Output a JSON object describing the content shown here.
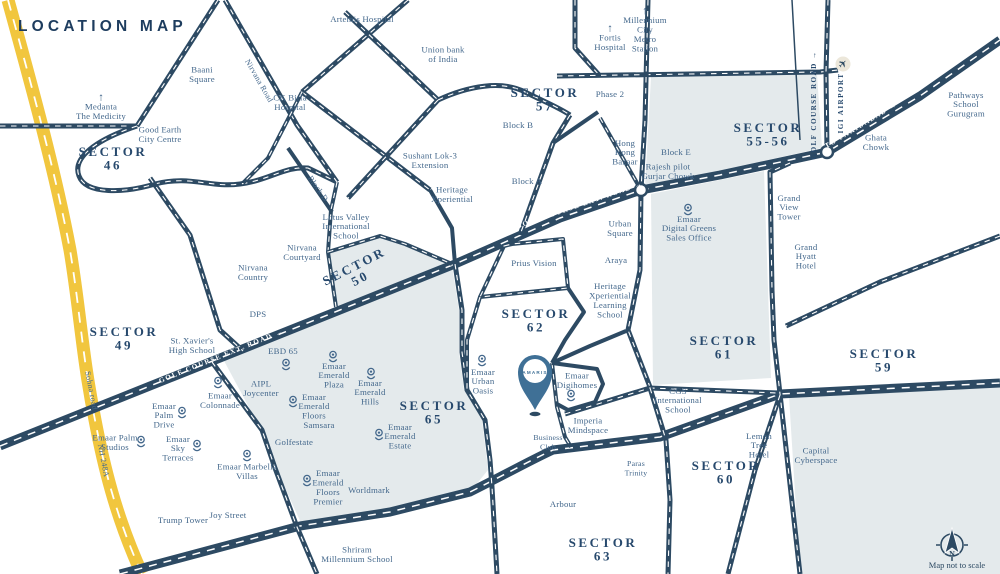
{
  "title": "LOCATION MAP",
  "footer": {
    "compass_label": "N",
    "disclaimer": "Map not to scale"
  },
  "colors": {
    "road": "#2d4a63",
    "road_dash": "#ffffff",
    "highway_yellow": "#f1c63e",
    "region": "#e4eaec",
    "label": "#44688c",
    "sector_label": "#27496d",
    "title": "#1d3c5e",
    "pin_fill": "#3f7096",
    "airport_bg": "#ece7da"
  },
  "map": {
    "project_pin": {
      "label": "AMARIS",
      "x": 535,
      "y": 372
    },
    "compass": {
      "x": 952,
      "y": 545
    },
    "airport_icon": {
      "x": 843,
      "y": 64
    },
    "junctions": [
      {
        "x": 641,
        "y": 190
      },
      {
        "x": 827,
        "y": 152
      }
    ],
    "sector_labels": [
      {
        "x": 113,
        "y": 158,
        "lines": [
          "SECTOR",
          "46"
        ]
      },
      {
        "x": 545,
        "y": 99,
        "lines": [
          "SECTOR",
          "57"
        ]
      },
      {
        "x": 768,
        "y": 134,
        "lines": [
          "SECTOR",
          "55-56"
        ]
      },
      {
        "x": 124,
        "y": 338,
        "lines": [
          "SECTOR",
          "49"
        ]
      },
      {
        "x": 357,
        "y": 272,
        "lines": [
          "SECTOR",
          "50"
        ],
        "rotate": -27
      },
      {
        "x": 536,
        "y": 320,
        "lines": [
          "SECTOR",
          "62"
        ]
      },
      {
        "x": 724,
        "y": 347,
        "lines": [
          "SECTOR",
          "61"
        ]
      },
      {
        "x": 884,
        "y": 360,
        "lines": [
          "SECTOR",
          "59"
        ]
      },
      {
        "x": 434,
        "y": 412,
        "lines": [
          "SECTOR",
          "65"
        ]
      },
      {
        "x": 726,
        "y": 472,
        "lines": [
          "SECTOR",
          "60"
        ]
      },
      {
        "x": 603,
        "y": 549,
        "lines": [
          "SECTOR",
          "63"
        ]
      }
    ],
    "road_labels": [
      {
        "text": "GOLF COURSE EXT. ROAD →",
        "x": 222,
        "y": 358,
        "rotate": -22,
        "style": "light"
      },
      {
        "text": "GOLF COURSE EXT. ROAD →",
        "x": 580,
        "y": 207,
        "rotate": -19,
        "style": "light"
      },
      {
        "text": "TO FARIDABAD →",
        "x": 862,
        "y": 127,
        "rotate": -31,
        "style": "light"
      },
      {
        "text": "GOLF COURSE ROAD →",
        "x": 816,
        "y": 105,
        "rotate": -90,
        "style": "dark"
      },
      {
        "text": "IGI AIRPORT",
        "x": 843,
        "y": 103,
        "rotate": -90,
        "style": "dark"
      },
      {
        "text": "Nirvana Road",
        "x": 257,
        "y": 82,
        "rotate": 60,
        "style": "serif"
      },
      {
        "text": "Block D",
        "x": 316,
        "y": 190,
        "rotate": 55,
        "style": "serif"
      },
      {
        "text": "Sohna road",
        "x": 89,
        "y": 391,
        "rotate": 79,
        "style": "serif"
      },
      {
        "text": "NH 248A",
        "x": 101,
        "y": 461,
        "rotate": 79,
        "style": "serif"
      }
    ],
    "landmarks": [
      {
        "x": 101,
        "y": 111,
        "lines": [
          "Medanta",
          "The Medicity"
        ],
        "arrow": true
      },
      {
        "x": 160,
        "y": 134,
        "lines": [
          "Good Earth",
          "City Centre"
        ]
      },
      {
        "x": 202,
        "y": 74,
        "lines": [
          "Baani",
          "Square"
        ]
      },
      {
        "x": 290,
        "y": 102,
        "lines": [
          "CK Birla",
          "Hospital"
        ]
      },
      {
        "x": 362,
        "y": 19,
        "lines": [
          "Artemis Hospital"
        ]
      },
      {
        "x": 443,
        "y": 54,
        "lines": [
          "Union bank",
          "of India"
        ]
      },
      {
        "x": 610,
        "y": 94,
        "lines": [
          "Phase 2"
        ]
      },
      {
        "x": 610,
        "y": 42,
        "lines": [
          "Fortis",
          "Hospital"
        ],
        "arrow": true
      },
      {
        "x": 645,
        "y": 34,
        "lines": [
          "Millennium",
          "City",
          "Metro",
          "Station"
        ],
        "arrow": true
      },
      {
        "x": 625,
        "y": 152,
        "lines": [
          "Hong",
          "Kong",
          "Bazaar"
        ]
      },
      {
        "x": 518,
        "y": 125,
        "lines": [
          "Block B"
        ]
      },
      {
        "x": 527,
        "y": 181,
        "lines": [
          "Block A"
        ]
      },
      {
        "x": 430,
        "y": 160,
        "lines": [
          "Sushant Lok-3",
          "Extension"
        ]
      },
      {
        "x": 452,
        "y": 194,
        "lines": [
          "Heritage",
          "Xperiential"
        ]
      },
      {
        "x": 676,
        "y": 152,
        "lines": [
          "Block E"
        ]
      },
      {
        "x": 668,
        "y": 171,
        "lines": [
          "Rajesh pilot",
          "Gurjar Chowk"
        ]
      },
      {
        "x": 876,
        "y": 142,
        "lines": [
          "Ghata",
          "Chowk"
        ]
      },
      {
        "x": 966,
        "y": 104,
        "lines": [
          "Pathways",
          "School",
          "Gurugram"
        ]
      },
      {
        "x": 789,
        "y": 207,
        "lines": [
          "Grand",
          "View",
          "Tower"
        ]
      },
      {
        "x": 806,
        "y": 256,
        "lines": [
          "Grand",
          "Hyatt",
          "Hotel"
        ]
      },
      {
        "x": 620,
        "y": 228,
        "lines": [
          "Urban",
          "Square"
        ]
      },
      {
        "x": 616,
        "y": 260,
        "lines": [
          "Araya"
        ]
      },
      {
        "x": 610,
        "y": 300,
        "lines": [
          "Heritage",
          "Xperiential",
          "Learning",
          "School"
        ]
      },
      {
        "x": 534,
        "y": 263,
        "lines": [
          "Prius Vision"
        ]
      },
      {
        "x": 346,
        "y": 226,
        "lines": [
          "Lotus Valley",
          "International",
          "School"
        ]
      },
      {
        "x": 302,
        "y": 252,
        "lines": [
          "Nirvana",
          "Courtyard"
        ]
      },
      {
        "x": 253,
        "y": 272,
        "lines": [
          "Nirvana",
          "Country"
        ]
      },
      {
        "x": 258,
        "y": 314,
        "lines": [
          "DPS"
        ]
      },
      {
        "x": 192,
        "y": 345,
        "lines": [
          "St. Xavier's",
          "High School"
        ]
      },
      {
        "x": 283,
        "y": 351,
        "lines": [
          "EBD 65"
        ],
        "pin": {
          "x": 286,
          "y": 366
        }
      },
      {
        "x": 261,
        "y": 388,
        "lines": [
          "AIPL",
          "Joycenter"
        ]
      },
      {
        "x": 220,
        "y": 400,
        "lines": [
          "Emaar",
          "Colonnade"
        ],
        "pin": {
          "x": 218,
          "y": 384
        }
      },
      {
        "x": 164,
        "y": 415,
        "lines": [
          "Emaar",
          "Palm",
          "Drive"
        ],
        "pin": {
          "x": 182,
          "y": 414
        }
      },
      {
        "x": 115,
        "y": 442,
        "lines": [
          "Emaar Palm",
          "Studios"
        ],
        "pin": {
          "x": 141,
          "y": 443
        }
      },
      {
        "x": 178,
        "y": 448,
        "lines": [
          "Emaar",
          "Sky",
          "Terraces"
        ],
        "pin": {
          "x": 197,
          "y": 447
        }
      },
      {
        "x": 247,
        "y": 471,
        "lines": [
          "Emaar Marbella",
          "Villas"
        ],
        "pin": {
          "x": 247,
          "y": 457
        }
      },
      {
        "x": 334,
        "y": 375,
        "lines": [
          "Emaar",
          "Emerald",
          "Plaza"
        ],
        "pin": {
          "x": 333,
          "y": 358
        }
      },
      {
        "x": 314,
        "y": 406,
        "lines": [
          "Emaar",
          "Emerald",
          "Floors"
        ],
        "pin": {
          "x": 293,
          "y": 403
        }
      },
      {
        "x": 370,
        "y": 392,
        "lines": [
          "Emaar",
          "Emerald",
          "Hills"
        ],
        "pin": {
          "x": 371,
          "y": 375
        }
      },
      {
        "x": 319,
        "y": 425,
        "lines": [
          "Samsara"
        ]
      },
      {
        "x": 294,
        "y": 442,
        "lines": [
          "Golfestate"
        ]
      },
      {
        "x": 400,
        "y": 436,
        "lines": [
          "Emaar",
          "Emerald",
          "Estate"
        ],
        "pin": {
          "x": 379,
          "y": 436
        }
      },
      {
        "x": 328,
        "y": 487,
        "lines": [
          "Emaar",
          "Emerald",
          "Floors",
          "Premier"
        ],
        "pin": {
          "x": 307,
          "y": 482
        }
      },
      {
        "x": 369,
        "y": 490,
        "lines": [
          "Worldmark"
        ]
      },
      {
        "x": 183,
        "y": 520,
        "lines": [
          "Trump Tower"
        ]
      },
      {
        "x": 228,
        "y": 515,
        "lines": [
          "Joy Street"
        ]
      },
      {
        "x": 357,
        "y": 554,
        "lines": [
          "Shriram",
          "Millennium School"
        ]
      },
      {
        "x": 483,
        "y": 381,
        "lines": [
          "Emaar",
          "Urban",
          "Oasis"
        ],
        "pin": {
          "x": 482,
          "y": 362
        }
      },
      {
        "x": 577,
        "y": 380,
        "lines": [
          "Emaar",
          "Digihomes"
        ],
        "pin": {
          "x": 571,
          "y": 397
        }
      },
      {
        "x": 588,
        "y": 425,
        "lines": [
          "Imperia",
          "Mindspace"
        ]
      },
      {
        "x": 548,
        "y": 442,
        "lines": [
          "Business",
          "Club"
        ],
        "small": true
      },
      {
        "x": 636,
        "y": 468,
        "lines": [
          "Paras",
          "Trinity"
        ],
        "small": true
      },
      {
        "x": 563,
        "y": 504,
        "lines": [
          "Arbour"
        ]
      },
      {
        "x": 678,
        "y": 400,
        "lines": [
          "CGS",
          "International",
          "School"
        ]
      },
      {
        "x": 759,
        "y": 445,
        "lines": [
          "Lemon",
          "Tree",
          "Hotel"
        ]
      },
      {
        "x": 816,
        "y": 455,
        "lines": [
          "Capital",
          "Cyberspace"
        ]
      },
      {
        "x": 689,
        "y": 228,
        "lines": [
          "Emaar",
          "Digital Greens",
          "Sales Office"
        ],
        "pin": {
          "x": 688,
          "y": 211
        }
      }
    ]
  }
}
